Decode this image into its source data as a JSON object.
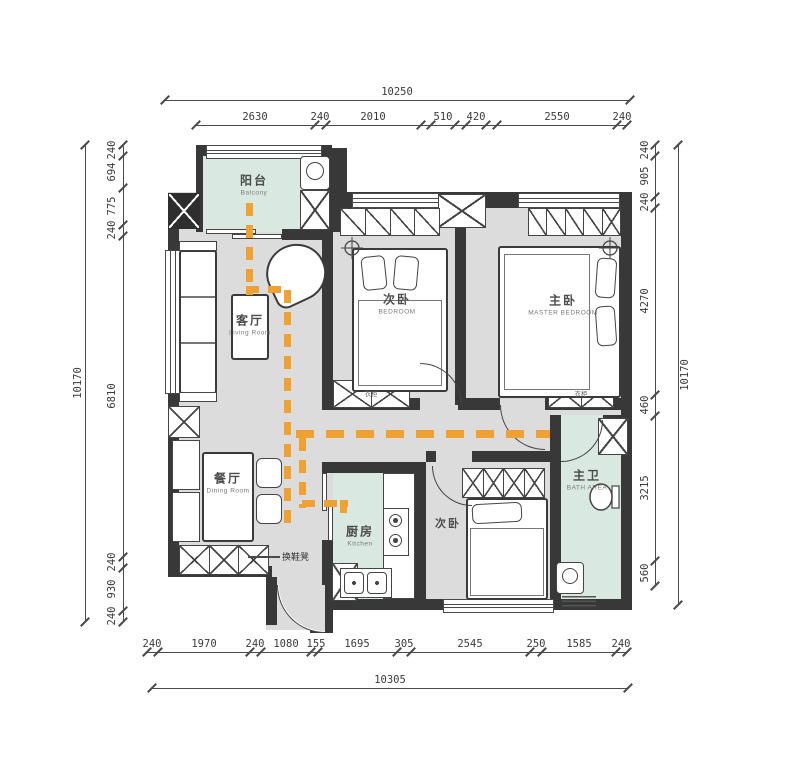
{
  "colors": {
    "wall": "#383838",
    "floor": "#dcdcdc",
    "wet_room": "#d9e8e0",
    "path_orange": "#efa231",
    "dim_text": "#3a3a3a"
  },
  "dimensions": {
    "top": {
      "total": "10250",
      "segments": [
        "2630",
        "240",
        "2010",
        "510",
        "420",
        "2550",
        "240"
      ]
    },
    "bottom": {
      "total": "10305",
      "segments": [
        "240",
        "1970",
        "240",
        "1080",
        "155",
        "1695",
        "305",
        "2545",
        "250",
        "1585",
        "240"
      ]
    },
    "left": {
      "total": "10170",
      "segments": [
        "240",
        "694",
        "775",
        "240",
        "6810",
        "240",
        "930",
        "240"
      ]
    },
    "right": {
      "total": "10170",
      "segments": [
        "240",
        "905",
        "240",
        "4270",
        "460",
        "3215",
        "560"
      ]
    }
  },
  "rooms": {
    "balcony": {
      "zh": "阳台",
      "en": "Balcony"
    },
    "living": {
      "zh": "客厅",
      "en": "Living Room"
    },
    "bedroom_top": {
      "zh": "次卧",
      "en": "BEDROOM"
    },
    "master": {
      "zh": "主卧",
      "en": "MASTER BEDROOM"
    },
    "dining": {
      "zh": "餐厅",
      "en": "Dining Room"
    },
    "kitchen": {
      "zh": "厨房",
      "en": "Kitchen"
    },
    "bedroom_bottom": {
      "zh": "次卧"
    },
    "bath": {
      "zh": "主卫",
      "en": "BATH AREA"
    }
  },
  "annotations": {
    "shoe_bench": "换鞋凳",
    "wardrobe": "衣柜"
  }
}
